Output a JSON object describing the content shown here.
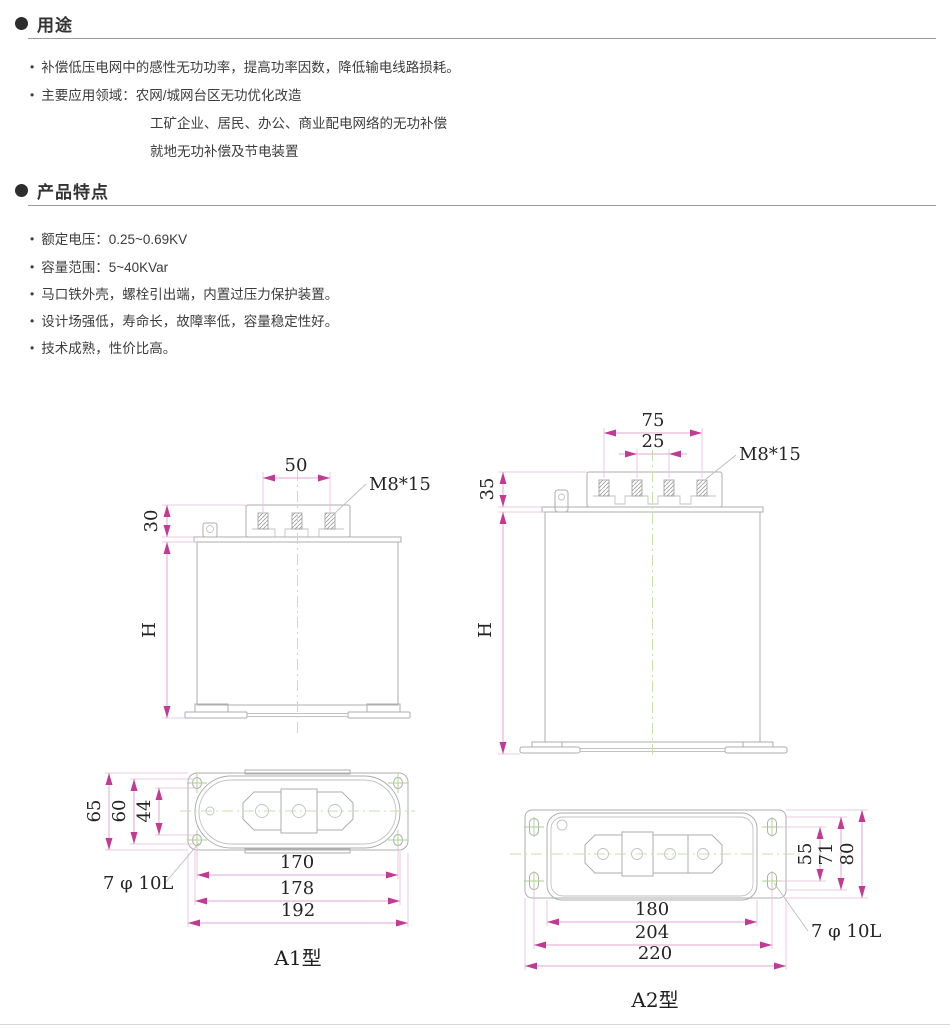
{
  "usage": {
    "title": "用途",
    "bullets": [
      "补偿低压电网中的感性无功功率，提高功率因数，降低输电线路损耗。",
      "主要应用领域：农网/城网台区无功优化改造"
    ],
    "sub_lines": [
      "工矿企业、居民、办公、商业配电网络的无功补偿",
      "就地无功补偿及节电装置"
    ]
  },
  "features": {
    "title": "产品特点",
    "bullets": [
      "额定电压：0.25~0.69KV",
      "容量范围：5~40KVar",
      "马口铁外壳，螺栓引出端，内置过压力保护装置。",
      "设计场强低，寿命长，故障率低，容量稳定性好。",
      "技术成熟，性价比高。"
    ]
  },
  "drawings": {
    "colors": {
      "dimension_accent": "#c13a93",
      "dimension_line": "#e3a7d3",
      "outline": "#aeaeae",
      "centerline": "#c9e0ab"
    },
    "a1": {
      "caption": "A1型",
      "front": {
        "terminal_pitch": "50",
        "thread_spec": "M8*15",
        "lid_height": "30",
        "body_height": "H"
      },
      "top": {
        "flange_height": "65",
        "body_depth": "60",
        "hole_pitch_v": "44",
        "hole_pitch_h": "170",
        "body_width": "178",
        "flange_width": "192",
        "hole_spec": "7 φ 10L"
      }
    },
    "a2": {
      "caption": "A2型",
      "front": {
        "terminal_span": "75",
        "terminal_pitch": "25",
        "thread_spec": "M8*15",
        "lid_height": "35",
        "body_height": "H"
      },
      "top": {
        "hole_pitch_v": "55",
        "hole_span_v": "71",
        "flange_height": "80",
        "body_width": "180",
        "hole_pitch_h": "204",
        "flange_width": "220",
        "hole_spec": "7 φ 10L"
      }
    }
  }
}
